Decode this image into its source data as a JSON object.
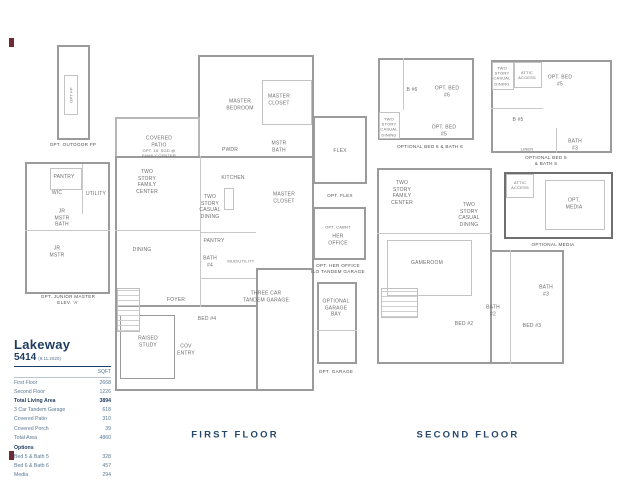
{
  "titles": {
    "first_floor": "FIRST FLOOR",
    "second_floor": "SECOND FLOOR"
  },
  "legend": {
    "title": "Lakeway",
    "plan_number": "5414",
    "date": "(9.11.2020)",
    "unit_header": "SQFT",
    "rows": [
      {
        "label": "First Floor",
        "value": "2668"
      },
      {
        "label": "Second Floor",
        "value": "1226"
      },
      {
        "label": "Total Living Area",
        "value": "3894"
      },
      {
        "label": "3 Car Tandem Garage",
        "value": "618"
      },
      {
        "label": "Covered Patio",
        "value": "310"
      },
      {
        "label": "Covered Porch",
        "value": "39"
      },
      {
        "label": "Total Area",
        "value": "4860"
      }
    ],
    "options_header": "Options",
    "option_rows": [
      {
        "label": "Bed 5 & Bath 5",
        "value": "328"
      },
      {
        "label": "Bed 6 & Bath 6",
        "value": "457"
      },
      {
        "label": "Media",
        "value": "294"
      },
      {
        "label": "Her Office",
        "value": "109"
      }
    ]
  },
  "outdoor_fp": {
    "label": "OPT FP",
    "caption": "OPT. OUTDOOR FP"
  },
  "junior_master": {
    "pantry": "PANTRY",
    "wic": "WIC",
    "utility": "UTILITY",
    "jr_mstr_bath": "JR\nMSTR\nBATH",
    "jr_mstr": "JR\nMSTR",
    "caption": "OPT. JUNIOR MASTER\nELEV. 'A'"
  },
  "first_floor": {
    "covered_patio": "COVERED\nPATIO",
    "opt_sgd": "OPT. 16' SGD @\nFAMILY CENTER",
    "master_bedroom": "MASTER\nBEDROOM",
    "master_closet_top": "MASTER\nCLOSET",
    "pwdr": "PWDR",
    "mstr_bath": "MSTR\nBATH",
    "kitchen": "KITCHEN",
    "family_center": "TWO\nSTORY\nFAMILY\nCENTER",
    "casual_dining": "TWO\nSTORY\nCASUAL\nDINING",
    "master_closet_mid": "MASTER\nCLOSET",
    "dining": "DINING",
    "pantry": "PANTRY",
    "bath4": "BATH\n#4",
    "mud_utility": "MUD/UTILITY",
    "garage": "THREE CAR\nTANDEM GARAGE",
    "foyer": "FOYER",
    "bed4": "BED #4",
    "raised_study": "RAISED\nSTUDY",
    "cov_entry": "COV\nENTRY"
  },
  "flex_plan": {
    "flex": "FLEX",
    "caption": "OPT. FLEX"
  },
  "her_office_plan": {
    "opt_cabnt": "OPT. CABNT",
    "her_office": "HER\nOFFICE",
    "caption": "OPT. HER OFFICE\nILO TANDEM GARAGE"
  },
  "garage_bay_plan": {
    "label": "OPTIONAL\nGARAGE\nBAY",
    "caption": "OPT. GARAGE"
  },
  "opt_bed6_plan": {
    "casual_dining": "TWO\nSTORY\nCASUAL\nDINING",
    "b6": "B #6",
    "bed6": "OPT. BED\n#6",
    "bed5": "OPT. BED\n#5",
    "caption": "OPTIONAL BED 6 & BATH 6"
  },
  "opt_bed5_plan": {
    "casual_dining": "TWO\nSTORY\nCASUAL\nDINING",
    "attic": "ATTIC\nACCESS",
    "bed5": "OPT. BED\n#5",
    "b5": "B #5",
    "linen": "LINEN",
    "bath3": "BATH\n#3",
    "caption": "OPTIONAL BED 5\n& BATH 5"
  },
  "second_floor": {
    "family_center": "TWO\nSTORY\nFAMILY\nCENTER",
    "casual_dining": "TWO\nSTORY\nCASUAL\nDINING",
    "gameroom": "GAMEROOM",
    "bath2": "BATH\n#2",
    "bed2": "BED #2",
    "bath3": "BATH\n#3",
    "bed3": "BED #3"
  },
  "opt_media_plan": {
    "attic": "ATTIC\nACCESS",
    "media": "OPT.\nMEDIA",
    "caption": "OPTIONAL MEDIA"
  },
  "colors": {
    "navy": "#1d3c5f",
    "wall_gray": "#9b9b9b",
    "label_gray": "#6e6e6e",
    "mark_maroon": "#6e2b36"
  }
}
